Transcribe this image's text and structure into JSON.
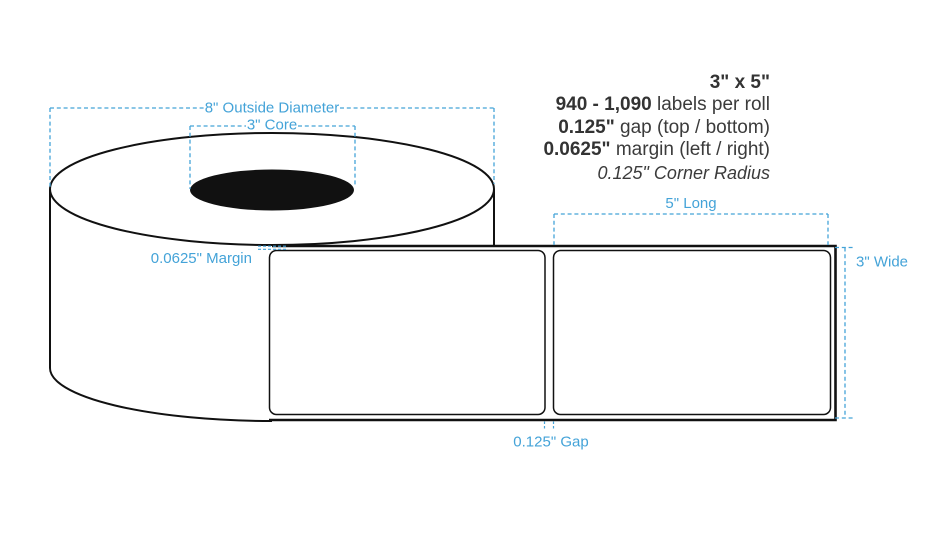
{
  "page": {
    "background": "#ffffff",
    "description": "Label roll specification diagram"
  },
  "specs": {
    "size": "3\" x 5\"",
    "quantity": "940 - 1,090",
    "quantity_suffix": " labels per roll",
    "gap": "0.125\"",
    "gap_suffix": " gap (top / bottom)",
    "margin": "0.0625\"",
    "margin_suffix": " margin (left / right)",
    "corner_radius": "0.125\" Corner Radius"
  },
  "dimensions": {
    "outside_diameter": "8\" Outside Diameter",
    "core": "3\" Core",
    "margin": "0.0625\" Margin",
    "length": "5\" Long",
    "width": "3\" Wide",
    "gap": "0.125\" Gap"
  },
  "colors": {
    "dimension_blue": "#44a3d8",
    "ink_black": "#111111",
    "spec_text": "#3b3b3b"
  }
}
